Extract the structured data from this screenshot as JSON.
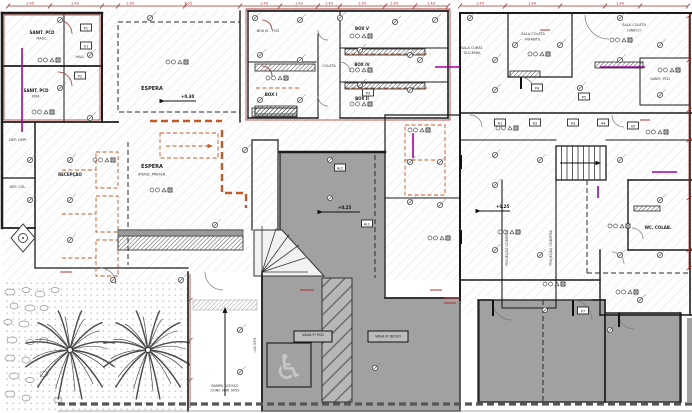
{
  "drawing": {
    "type": "architectural-floor-plan",
    "description": "Clinic ground-floor plan with collection boxes, waiting areas, ramp, garden and parking"
  },
  "colors": {
    "wall": "#1b1b1b",
    "dimension_red": "#9e2f28",
    "revision_orange": "#c35a26",
    "plumbing_magenta": "#a800a8",
    "paving_gray": "#a1a1a1",
    "hatch_gray": "#d2d2d2"
  },
  "labels": {
    "sanit_masc_1": "SANIT. PCD",
    "sanit_masc_2": "MASC.",
    "sanit_fem_1": "SANIT. PCD",
    "sanit_fem_2": "FEM.",
    "hall": "HALL",
    "dep_limp": "DEP. LIMP.",
    "dep_col": "DEP. COL.",
    "espera_top": "ESPERA",
    "box_iii": "BOX III - PCD",
    "box_i": "BOX I",
    "coleta": "COLETA",
    "box_v": "BOX V",
    "box_iv": "BOX IV",
    "box_ii": "BOX II",
    "sala_curat_1": "SALA CURAT.",
    "sala_curat_2": "GLICEMIA",
    "sala_inf_1": "SALA COLETA",
    "sala_inf_2": "INFANTIL",
    "sala_gin_1": "SALA COLETA",
    "sala_gin_2": "GINECO",
    "sanit_pcd": "SANIT. PCD",
    "recepcao": "RECEPÇÃO",
    "espera_mid": "ESPERA",
    "atend": "ATEND. PREFER.",
    "wc_colab": "WC. COLAB.",
    "proj_coberta": "PROJEÇÃO COBERTA",
    "vaga_pcd": "VAGA P/ PCD",
    "vaga_idoso": "VAGA P/ IDOSO",
    "rampa_1": "RAMPA ACESSO",
    "rampa_2": "CONF. NBR 9050",
    "rampa_slope": "i=8.33%"
  },
  "levels": {
    "espera": "+0.30",
    "plaza": "+0.25",
    "corredor": "+0.25"
  },
  "icons": {
    "wheelchair": "♿",
    "north_diamond": "◈"
  },
  "dims": [
    "1.45",
    "1.40",
    "1.40",
    "3.05",
    "1.40",
    "1.40",
    "1.45",
    "1.40",
    "1.45",
    "1.40",
    "1.45",
    "1.40",
    "1.40"
  ],
  "tags": [
    "P1",
    "V1",
    "P2",
    "P3",
    "P4",
    "P5",
    "A1",
    "A2",
    "A3",
    "A4",
    "A5",
    "ALC",
    "ALC",
    "P7"
  ]
}
